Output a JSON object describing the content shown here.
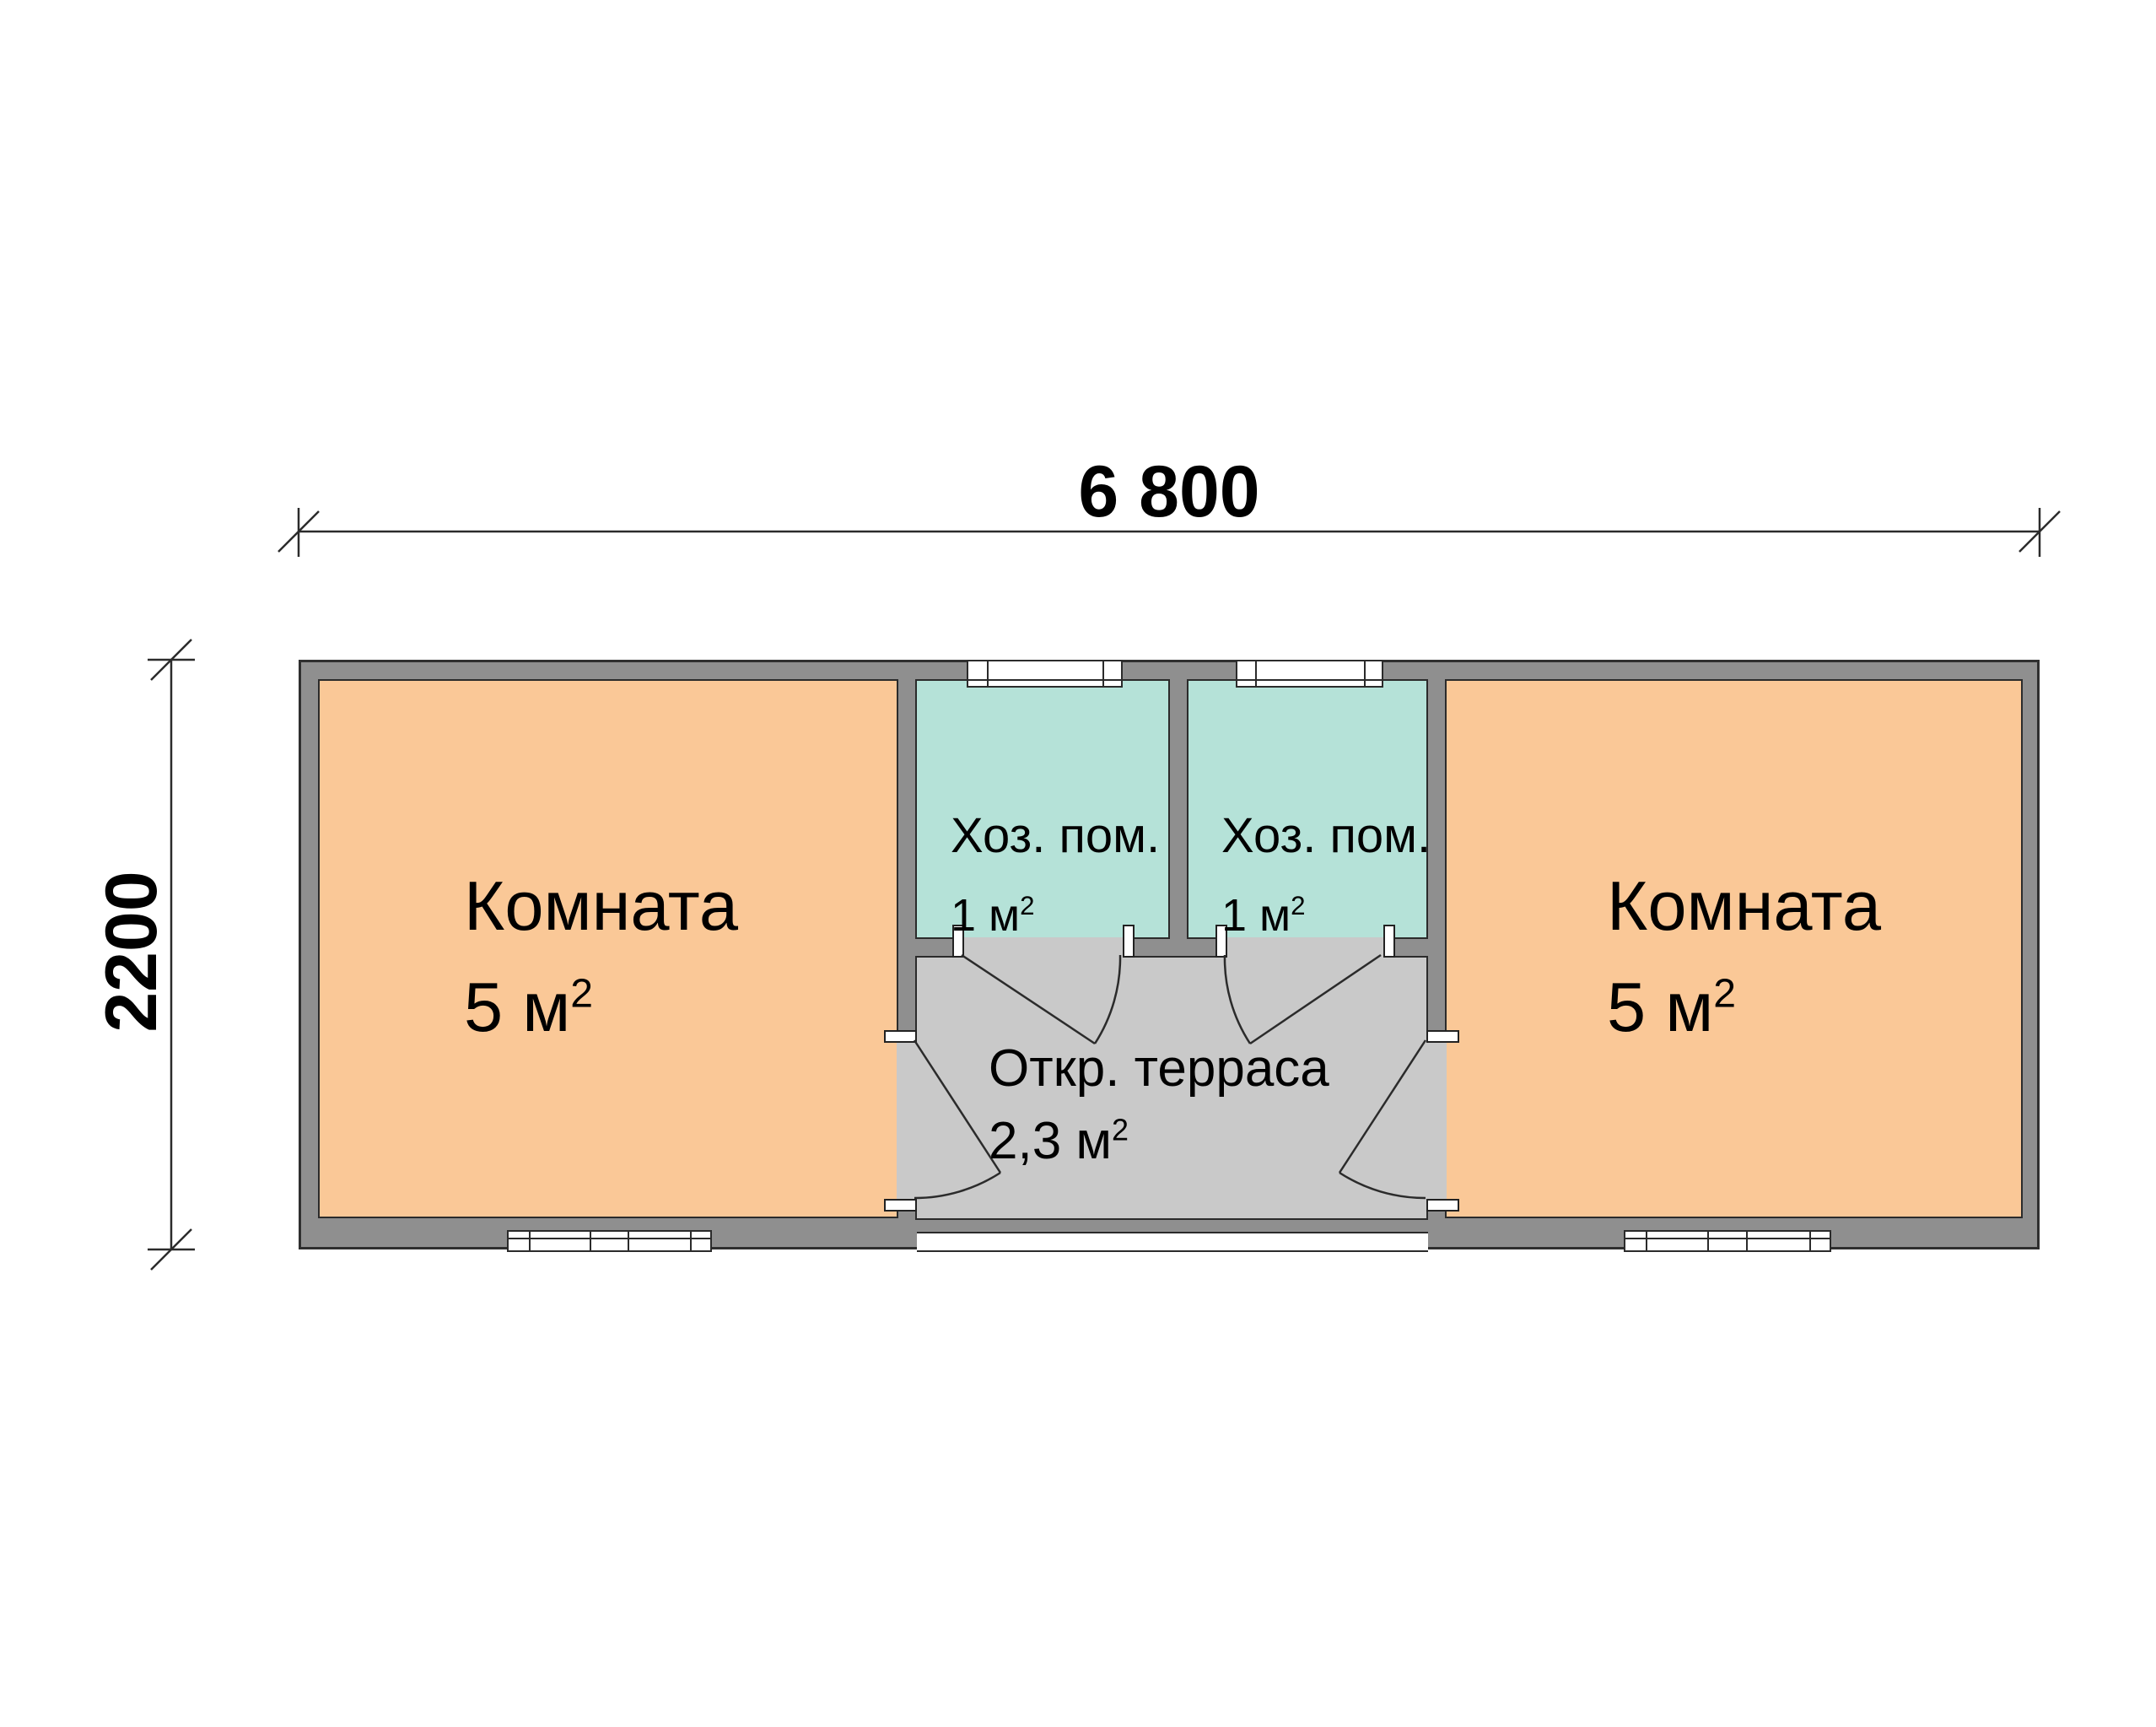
{
  "palette": {
    "wall_fill": "#8f8f8f",
    "room_fill": "#fac897",
    "utility_fill": "#b5e2d8",
    "terrace_fill": "#c9c9c9",
    "line_color": "#2b2b2b",
    "window_fill": "#ffffff"
  },
  "dimensions": {
    "width_label": "6 800",
    "height_label": "2200"
  },
  "rooms": {
    "left_room": {
      "name": "Комната",
      "area": "5 м",
      "area_sup": "2"
    },
    "right_room": {
      "name": "Комната",
      "area": "5 м",
      "area_sup": "2"
    },
    "utility_left": {
      "name": "Хоз. пом.",
      "area": "1 м",
      "area_sup": "2"
    },
    "utility_right": {
      "name": "Хоз. пом.",
      "area": "1 м",
      "area_sup": "2"
    },
    "terrace": {
      "name": "Откр. терраса",
      "area": "2,3 м",
      "area_sup": "2"
    }
  }
}
